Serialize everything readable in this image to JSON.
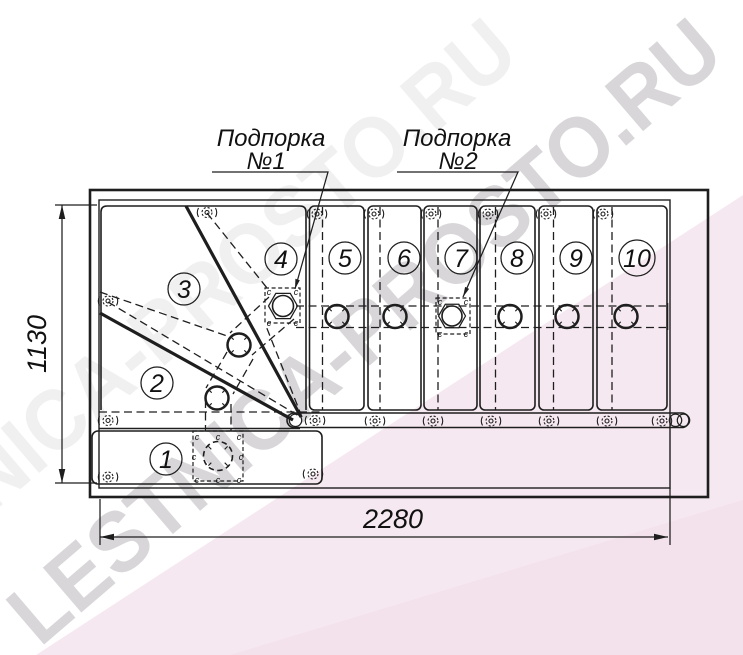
{
  "watermark": {
    "text": "LESTNICA-PROSTO.RU"
  },
  "supports": {
    "s1": {
      "line1": "Подпорка",
      "line2": "№1"
    },
    "s2": {
      "line1": "Подпорка",
      "line2": "№2"
    }
  },
  "dims": {
    "width": "2280",
    "depth": "1130"
  },
  "step_numbers": [
    "1",
    "2",
    "3",
    "4",
    "5",
    "6",
    "7",
    "8",
    "9",
    "10"
  ],
  "marks": {
    "weld": "c"
  },
  "colors": {
    "line": "#1e1e1e",
    "tint_light": "#f6e8f0",
    "tint_dark": "#f2dfeb",
    "watermark_gray": "#a09aa2"
  }
}
